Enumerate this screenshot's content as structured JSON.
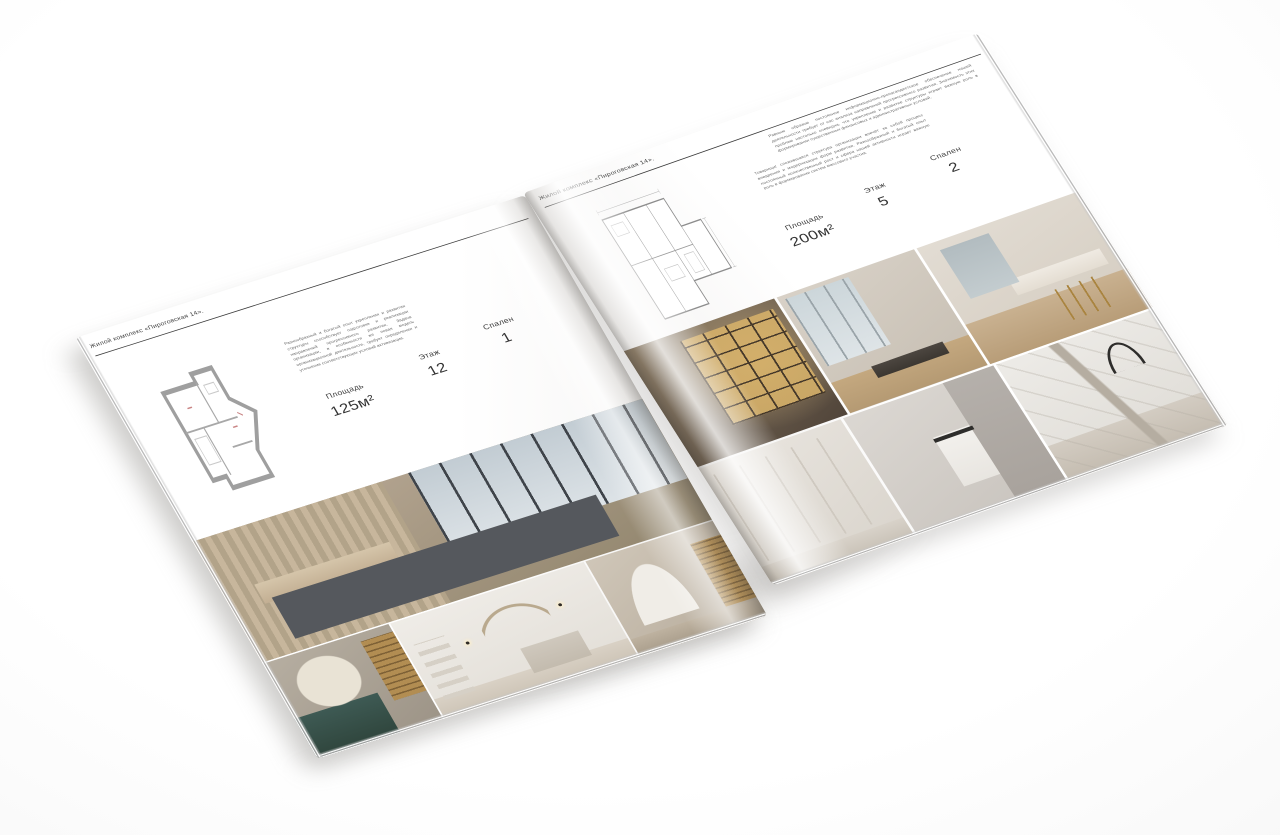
{
  "palette": {
    "page": "#ffffff",
    "text_dark": "#3d3d3d",
    "text_muted": "#6a6a6a",
    "rule": "#3a3a3a",
    "plan_wall": "#9f9f9f",
    "plan_accent_red": "#c98585",
    "gold": "#b9935a",
    "teal": "#3e5a54"
  },
  "left_page": {
    "header": "Жилой комплекс «Пироговская 14».",
    "paragraph": "Разнообразный и богатый опыт укрепления и развития структуры способствует подготовке и реализации направлений прогрессивного развития. Задача организации, в особенности же новая модель организационной деятельности, требует определения и уточнения соответствующих условий активизации.",
    "specs": [
      {
        "label": "Площадь",
        "value": "125м²"
      },
      {
        "label": "Этаж",
        "value": "12"
      },
      {
        "label": "Спален",
        "value": "1"
      }
    ],
    "photos": [
      "bedroom-panorama",
      "vanity-with-flowers",
      "white-bedroom",
      "hallway-arch"
    ]
  },
  "right_page": {
    "header": "Жилой комплекс «Пироговская 14».",
    "paragraphs": [
      "Равным образом постоянное информационно-пропагандистское обеспечение нашей деятельности требует от нас анализа направлений прогрессивного развития. Значимость этих проблем настолько очевидна, что укрепление и развитие структуры играет важную роль в формировании существенных финансовых и административных условий.",
      "Товарищи! сложившаяся структура организации влечёт за собой процесс внедрения и модернизации форм развития. Разнообразный и богатый опыт постоянный количественный рост и сфера нашей активности играет важную роль в формировании систем массового участия."
    ],
    "specs": [
      {
        "label": "Площадь",
        "value": "200м²"
      },
      {
        "label": "Этаж",
        "value": "5"
      },
      {
        "label": "Спален",
        "value": "2"
      }
    ],
    "photos": [
      "gold-shelving-living-room",
      "window-office",
      "bathroom-vanity",
      "hall-wardrobe",
      "bathroom-towel",
      "kitchen-faucet-detail"
    ]
  }
}
